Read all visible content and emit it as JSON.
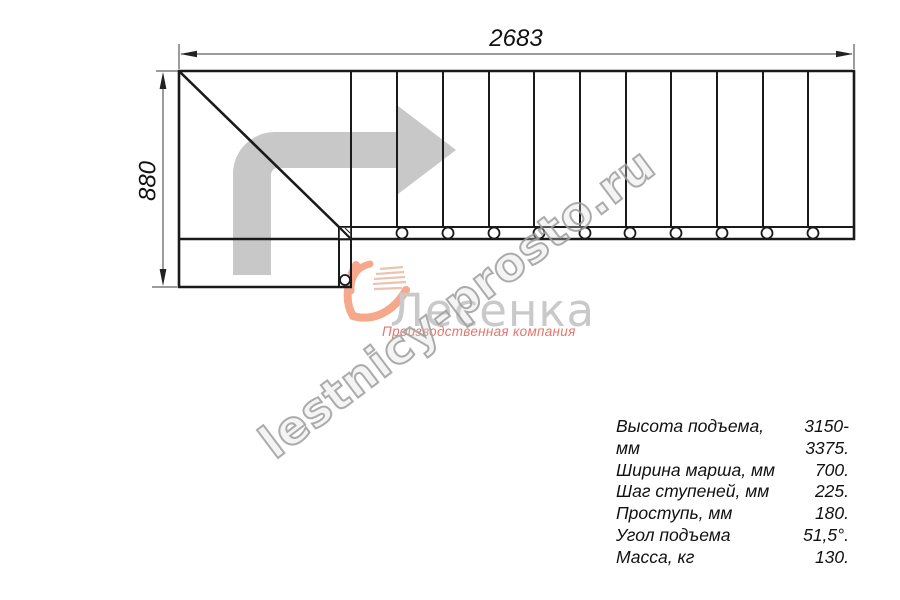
{
  "drawing": {
    "top_dimension": "2683",
    "left_dimension": "880",
    "steps_count": 11
  },
  "watermark": {
    "text": "lestnicy-prosto.ru"
  },
  "logo": {
    "name": "Лесенка",
    "tagline": "Производственная компания"
  },
  "specs": {
    "rows": [
      {
        "label": "Высота подъема, мм",
        "value": "3150-3375."
      },
      {
        "label": "Ширина марша, мм",
        "value": "700."
      },
      {
        "label": "Шаг ступеней, мм",
        "value": "225."
      },
      {
        "label": "Проступь, мм",
        "value": "180."
      },
      {
        "label": "Угол подъема",
        "value": "51,5°."
      },
      {
        "label": "Масса, кг",
        "value": "130."
      }
    ]
  },
  "colors": {
    "line": "#1a1a1a",
    "dimension": "#3a3a3a",
    "direction_arrow": "#c8c8c8",
    "watermark_gray": "#9e9e9e",
    "logo_gray": "#c9c9c9",
    "logo_red": "#e4756b",
    "logo_peach": "#f6a88c"
  }
}
